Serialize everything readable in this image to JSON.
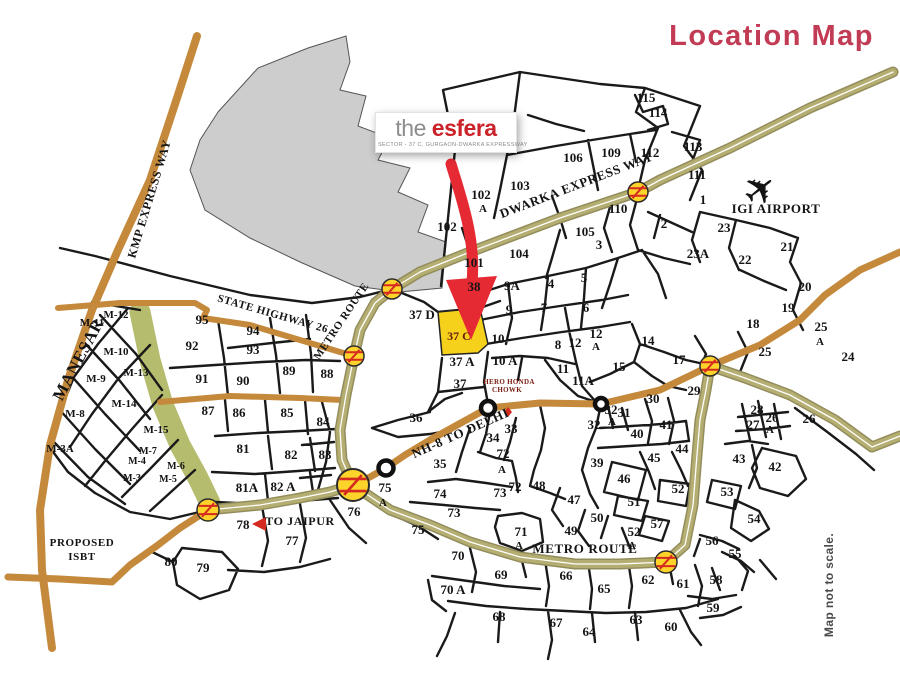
{
  "title": {
    "text": "Location Map",
    "color": "#c23b55"
  },
  "logo": {
    "the": "the",
    "brand": "esfera",
    "subtitle": "SECTOR - 37 C, GURGAON-DWARKA EXPRESSWAY"
  },
  "icons": {
    "airplane": "✈"
  },
  "colors": {
    "road_tan": "#c5893c",
    "road_khaki": "#b5ae72",
    "khaki_edge": "#938d5c",
    "green_strip": "#b6bc6d",
    "gray_area": "#cdcdcd",
    "highlight_yellow": "#f6d11c",
    "arrow_red": "#e52a33",
    "station_yellow": "#ffd42a",
    "station_red": "#d42a20"
  },
  "map": {
    "highlight": {
      "label": "37 C"
    },
    "labels": [
      {
        "t": "KMP EXPRESS WAY",
        "x": 153,
        "y": 200,
        "r": -73,
        "s": 12,
        "k": "road"
      },
      {
        "t": "DWARKA EXPRESS WAY",
        "x": 578,
        "y": 189,
        "r": -21,
        "s": 13,
        "k": "road"
      },
      {
        "t": "STATE HIGHWAY 26",
        "x": 272,
        "y": 317,
        "r": 16,
        "s": 11,
        "k": "road"
      },
      {
        "t": "METRO ROUTE",
        "x": 344,
        "y": 323,
        "r": -56,
        "s": 11,
        "k": "road"
      },
      {
        "t": "NH-8 TO DELHI",
        "x": 462,
        "y": 437,
        "r": -24,
        "s": 13,
        "k": "road"
      },
      {
        "t": "METRO ROUTE",
        "x": 585,
        "y": 553,
        "s": 13,
        "k": "road"
      },
      {
        "t": "MANESAR",
        "x": 83,
        "y": 362,
        "r": -62,
        "s": 17,
        "k": "road"
      },
      {
        "t": "TO JAIPUR",
        "x": 300,
        "y": 525,
        "s": 12,
        "k": "road"
      },
      {
        "t": "PROPOSED",
        "x": 82,
        "y": 546,
        "s": 11,
        "k": "road"
      },
      {
        "t": "ISBT",
        "x": 82,
        "y": 560,
        "s": 11,
        "k": "road"
      },
      {
        "t": "IGI AIRPORT",
        "x": 776,
        "y": 213,
        "s": 13,
        "k": "road"
      },
      {
        "t": "HERO HONDA",
        "x": 509,
        "y": 384,
        "s": 7,
        "k": "hh"
      },
      {
        "t": "CHOWK",
        "x": 507,
        "y": 392,
        "s": 7,
        "k": "hh"
      },
      {
        "t": "37 C",
        "x": 459,
        "y": 340,
        "s": 12,
        "k": "hl"
      },
      {
        "t": "Map not to scale.",
        "x": 833,
        "y": 585,
        "r": -90,
        "s": 12,
        "k": "note"
      },
      {
        "t": "115",
        "x": 646,
        "y": 102
      },
      {
        "t": "114",
        "x": 658,
        "y": 117
      },
      {
        "t": "113",
        "x": 693,
        "y": 151
      },
      {
        "t": "112",
        "x": 650,
        "y": 157
      },
      {
        "t": "111",
        "x": 697,
        "y": 179
      },
      {
        "t": "109",
        "x": 611,
        "y": 157
      },
      {
        "t": "106",
        "x": 573,
        "y": 162
      },
      {
        "t": "107",
        "x": 490,
        "y": 138
      },
      {
        "t": "110",
        "x": 618,
        "y": 213
      },
      {
        "t": "103",
        "x": 520,
        "y": 190
      },
      {
        "t": "102",
        "x": 481,
        "y": 199
      },
      {
        "t": "A",
        "x": 483,
        "y": 212,
        "s": 11
      },
      {
        "t": "102",
        "x": 447,
        "y": 231
      },
      {
        "t": "104",
        "x": 519,
        "y": 258
      },
      {
        "t": "105",
        "x": 585,
        "y": 236
      },
      {
        "t": "101",
        "x": 474,
        "y": 267
      },
      {
        "t": "3",
        "x": 599,
        "y": 249
      },
      {
        "t": "2",
        "x": 664,
        "y": 228
      },
      {
        "t": "1",
        "x": 703,
        "y": 204
      },
      {
        "t": "23",
        "x": 724,
        "y": 232
      },
      {
        "t": "23A",
        "x": 698,
        "y": 258
      },
      {
        "t": "22",
        "x": 745,
        "y": 264
      },
      {
        "t": "21",
        "x": 787,
        "y": 251
      },
      {
        "t": "20",
        "x": 805,
        "y": 291
      },
      {
        "t": "19",
        "x": 788,
        "y": 312
      },
      {
        "t": "18",
        "x": 753,
        "y": 328
      },
      {
        "t": "25",
        "x": 821,
        "y": 331
      },
      {
        "t": "A",
        "x": 820,
        "y": 345,
        "s": 11
      },
      {
        "t": "24",
        "x": 848,
        "y": 361
      },
      {
        "t": "25",
        "x": 765,
        "y": 356
      },
      {
        "t": "38",
        "x": 474,
        "y": 291
      },
      {
        "t": "9A",
        "x": 512,
        "y": 290
      },
      {
        "t": "4",
        "x": 551,
        "y": 288
      },
      {
        "t": "5",
        "x": 584,
        "y": 282
      },
      {
        "t": "9",
        "x": 509,
        "y": 314
      },
      {
        "t": "7",
        "x": 544,
        "y": 312
      },
      {
        "t": "6",
        "x": 586,
        "y": 312
      },
      {
        "t": "37 D",
        "x": 422,
        "y": 319
      },
      {
        "t": "10",
        "x": 498,
        "y": 343
      },
      {
        "t": "8",
        "x": 558,
        "y": 349
      },
      {
        "t": "12",
        "x": 575,
        "y": 347
      },
      {
        "t": "12",
        "x": 596,
        "y": 338
      },
      {
        "t": "A",
        "x": 596,
        "y": 350,
        "s": 11
      },
      {
        "t": "14",
        "x": 648,
        "y": 345
      },
      {
        "t": "37 A",
        "x": 462,
        "y": 366
      },
      {
        "t": "10 A",
        "x": 505,
        "y": 365
      },
      {
        "t": "11",
        "x": 563,
        "y": 373
      },
      {
        "t": "15",
        "x": 619,
        "y": 371
      },
      {
        "t": "11A",
        "x": 583,
        "y": 385
      },
      {
        "t": "37",
        "x": 460,
        "y": 388
      },
      {
        "t": "17",
        "x": 679,
        "y": 364
      },
      {
        "t": "29",
        "x": 694,
        "y": 395
      },
      {
        "t": "30",
        "x": 653,
        "y": 403
      },
      {
        "t": "32",
        "x": 611,
        "y": 414
      },
      {
        "t": "A",
        "x": 612,
        "y": 425,
        "s": 11
      },
      {
        "t": "31",
        "x": 624,
        "y": 417
      },
      {
        "t": "32",
        "x": 594,
        "y": 429
      },
      {
        "t": "41",
        "x": 666,
        "y": 429
      },
      {
        "t": "40",
        "x": 637,
        "y": 438
      },
      {
        "t": "28",
        "x": 757,
        "y": 414
      },
      {
        "t": "27",
        "x": 753,
        "y": 429
      },
      {
        "t": "26",
        "x": 772,
        "y": 422
      },
      {
        "t": "A",
        "x": 770,
        "y": 433,
        "s": 11
      },
      {
        "t": "26",
        "x": 809,
        "y": 423
      },
      {
        "t": "44",
        "x": 682,
        "y": 453
      },
      {
        "t": "43",
        "x": 739,
        "y": 463
      },
      {
        "t": "42",
        "x": 775,
        "y": 471
      },
      {
        "t": "45",
        "x": 654,
        "y": 462
      },
      {
        "t": "39",
        "x": 597,
        "y": 467
      },
      {
        "t": "46",
        "x": 624,
        "y": 483
      },
      {
        "t": "52",
        "x": 678,
        "y": 493
      },
      {
        "t": "53",
        "x": 727,
        "y": 496
      },
      {
        "t": "47",
        "x": 574,
        "y": 504
      },
      {
        "t": "48",
        "x": 539,
        "y": 490
      },
      {
        "t": "36",
        "x": 416,
        "y": 422
      },
      {
        "t": "33",
        "x": 511,
        "y": 433
      },
      {
        "t": "34",
        "x": 493,
        "y": 442
      },
      {
        "t": "35",
        "x": 440,
        "y": 468
      },
      {
        "t": "72",
        "x": 503,
        "y": 458
      },
      {
        "t": "A",
        "x": 502,
        "y": 473,
        "s": 11
      },
      {
        "t": "72",
        "x": 515,
        "y": 491
      },
      {
        "t": "73",
        "x": 500,
        "y": 497
      },
      {
        "t": "74",
        "x": 440,
        "y": 498
      },
      {
        "t": "73",
        "x": 454,
        "y": 517
      },
      {
        "t": "75",
        "x": 385,
        "y": 492
      },
      {
        "t": "A",
        "x": 383,
        "y": 506,
        "s": 11
      },
      {
        "t": "75",
        "x": 418,
        "y": 534
      },
      {
        "t": "76",
        "x": 354,
        "y": 516
      },
      {
        "t": "84",
        "x": 323,
        "y": 426
      },
      {
        "t": "83",
        "x": 325,
        "y": 459
      },
      {
        "t": "85",
        "x": 287,
        "y": 417
      },
      {
        "t": "86",
        "x": 239,
        "y": 417
      },
      {
        "t": "87",
        "x": 208,
        "y": 415
      },
      {
        "t": "88",
        "x": 327,
        "y": 378
      },
      {
        "t": "89",
        "x": 289,
        "y": 375
      },
      {
        "t": "90",
        "x": 243,
        "y": 385
      },
      {
        "t": "91",
        "x": 202,
        "y": 383
      },
      {
        "t": "92",
        "x": 192,
        "y": 350
      },
      {
        "t": "93",
        "x": 253,
        "y": 354
      },
      {
        "t": "94",
        "x": 253,
        "y": 335
      },
      {
        "t": "95",
        "x": 202,
        "y": 324
      },
      {
        "t": "81",
        "x": 243,
        "y": 453
      },
      {
        "t": "82",
        "x": 291,
        "y": 459
      },
      {
        "t": "81A",
        "x": 247,
        "y": 492
      },
      {
        "t": "82 A",
        "x": 283,
        "y": 491
      },
      {
        "t": "78",
        "x": 243,
        "y": 529
      },
      {
        "t": "77",
        "x": 292,
        "y": 545
      },
      {
        "t": "79",
        "x": 203,
        "y": 572
      },
      {
        "t": "80",
        "x": 171,
        "y": 566
      },
      {
        "t": "70",
        "x": 458,
        "y": 560
      },
      {
        "t": "69",
        "x": 501,
        "y": 579
      },
      {
        "t": "70 A",
        "x": 453,
        "y": 594
      },
      {
        "t": "68",
        "x": 499,
        "y": 621
      },
      {
        "t": "67",
        "x": 556,
        "y": 627
      },
      {
        "t": "64",
        "x": 589,
        "y": 636
      },
      {
        "t": "63",
        "x": 636,
        "y": 624
      },
      {
        "t": "60",
        "x": 671,
        "y": 631
      },
      {
        "t": "65",
        "x": 604,
        "y": 593
      },
      {
        "t": "66",
        "x": 566,
        "y": 580
      },
      {
        "t": "62",
        "x": 648,
        "y": 584
      },
      {
        "t": "61",
        "x": 683,
        "y": 588
      },
      {
        "t": "59",
        "x": 713,
        "y": 612
      },
      {
        "t": "58",
        "x": 716,
        "y": 584
      },
      {
        "t": "56",
        "x": 712,
        "y": 545
      },
      {
        "t": "55",
        "x": 735,
        "y": 558
      },
      {
        "t": "54",
        "x": 754,
        "y": 523
      },
      {
        "t": "57",
        "x": 657,
        "y": 528
      },
      {
        "t": "52",
        "x": 634,
        "y": 536
      },
      {
        "t": "A",
        "x": 632,
        "y": 549,
        "s": 11
      },
      {
        "t": "51",
        "x": 634,
        "y": 506
      },
      {
        "t": "50",
        "x": 597,
        "y": 522
      },
      {
        "t": "49",
        "x": 571,
        "y": 535
      },
      {
        "t": "71",
        "x": 521,
        "y": 536
      },
      {
        "t": "A",
        "x": 519,
        "y": 549,
        "s": 11
      },
      {
        "t": "M-12",
        "x": 116,
        "y": 318,
        "s": 11
      },
      {
        "t": "M-11",
        "x": 92,
        "y": 326,
        "s": 11
      },
      {
        "t": "M-10",
        "x": 116,
        "y": 355,
        "s": 11
      },
      {
        "t": "M-13",
        "x": 136,
        "y": 376,
        "s": 11
      },
      {
        "t": "M-9",
        "x": 96,
        "y": 382,
        "s": 11
      },
      {
        "t": "M-14",
        "x": 124,
        "y": 407,
        "s": 11
      },
      {
        "t": "M-8",
        "x": 75,
        "y": 417,
        "s": 11
      },
      {
        "t": "M-15",
        "x": 156,
        "y": 433,
        "s": 11
      },
      {
        "t": "M-7",
        "x": 148,
        "y": 454,
        "s": 10
      },
      {
        "t": "M-4",
        "x": 137,
        "y": 464,
        "s": 10
      },
      {
        "t": "M-6",
        "x": 176,
        "y": 469,
        "s": 10
      },
      {
        "t": "M-3",
        "x": 132,
        "y": 481,
        "s": 10
      },
      {
        "t": "M-5",
        "x": 168,
        "y": 482,
        "s": 10
      },
      {
        "t": "M-3A",
        "x": 60,
        "y": 452,
        "s": 11
      }
    ],
    "stations": [
      {
        "x": 638,
        "y": 192,
        "r": 10
      },
      {
        "x": 392,
        "y": 289,
        "r": 10
      },
      {
        "x": 354,
        "y": 356,
        "r": 10
      },
      {
        "x": 208,
        "y": 510,
        "r": 11
      },
      {
        "x": 666,
        "y": 562,
        "r": 11
      },
      {
        "x": 710,
        "y": 366,
        "r": 10
      }
    ],
    "toll": {
      "x": 353,
      "y": 485,
      "r": 16
    },
    "junctions": [
      {
        "x": 386,
        "y": 468,
        "r": 7.5
      },
      {
        "x": 488,
        "y": 408,
        "r": 7
      },
      {
        "x": 601,
        "y": 404,
        "r": 6
      }
    ]
  }
}
